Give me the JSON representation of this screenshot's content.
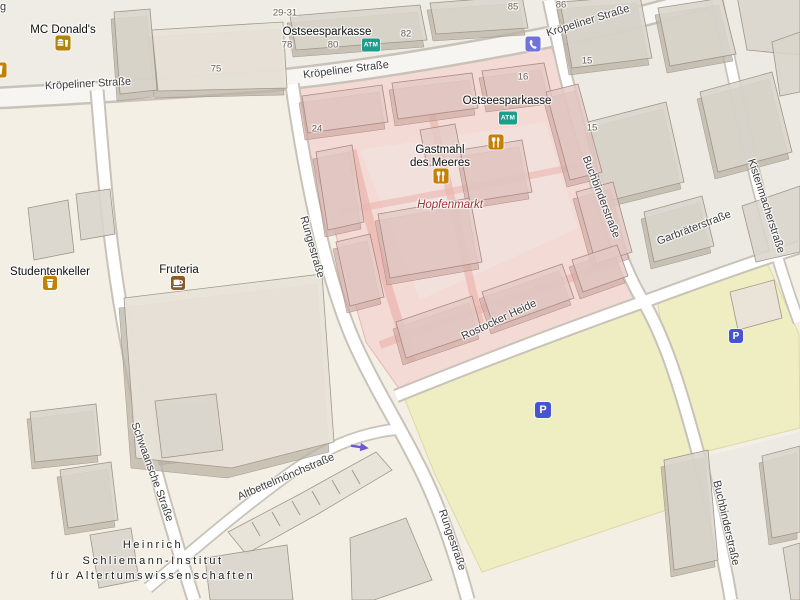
{
  "map": {
    "streets": [
      {
        "label": "Kröpeliner Straße"
      },
      {
        "label": "Kröpeliner Straße"
      },
      {
        "label": "Kröpeliner Straße"
      },
      {
        "label": "Rungestraße"
      },
      {
        "label": "Rungestraße"
      },
      {
        "label": "Buchbinderstraße"
      },
      {
        "label": "Buchbinderstraße"
      },
      {
        "label": "Kistenmacherstraße"
      },
      {
        "label": "Garbräterstraße"
      },
      {
        "label": "Rostocker Heide"
      },
      {
        "label": "Schwaansche Straße"
      },
      {
        "label": "Altbettelmönchstraße"
      }
    ],
    "pois": {
      "mcdonalds": "MC Donald's",
      "ostseesparkasse_1": "Ostseesparkasse",
      "ostseesparkasse_2": "Ostseesparkasse",
      "gastmahl_line1": "Gastmahl",
      "gastmahl_line2": "des Meeres",
      "hopfenmarkt": "Hopfenmarkt",
      "studentenkeller": "Studentenkeller",
      "fruteria": "Fruteria",
      "institute_line1": "Heinrich",
      "institute_line2": "Schliemann-Institut",
      "institute_line3": "für Altertumswissenschaften"
    },
    "house_numbers": [
      {
        "label": "29-31"
      },
      {
        "label": "75"
      },
      {
        "label": "78"
      },
      {
        "label": "80"
      },
      {
        "label": "82"
      },
      {
        "label": "85"
      },
      {
        "label": "86"
      },
      {
        "label": "16"
      },
      {
        "label": "15"
      },
      {
        "label": "15"
      },
      {
        "label": "24"
      }
    ],
    "icon_labels": {
      "atm": "ATM",
      "parking": "P"
    },
    "icons": {
      "atm": "teal ATM badge",
      "parking": "blue parking square",
      "phone": "purple phone handset",
      "restaurant": "orange fork and knife",
      "fastfood": "gold burger and drink",
      "bar": "orange drink glass",
      "cafe": "brown coffee cup",
      "oneway": "purple left arrow"
    },
    "edge_fragment": "g",
    "colors": {
      "land": "#f3efe5",
      "pedestrian_block": "#efece6",
      "market_overlay": "#f3dad4",
      "market_path": "#ecb6b0",
      "parking_lot": "#efedc2",
      "road": "#ffffff",
      "building_roof": "#dad5cc",
      "building_wall": "#b9b1a4",
      "pink_roof": "#e3c9c4",
      "atm_teal": "#1d9d8b",
      "poi_orange": "#c58000",
      "fastfood_gold": "#b08408",
      "cafe_brown": "#8a5a28",
      "phone_purple": "#7173d9",
      "parking_blue": "#4653d2",
      "oneway_purple": "#6a5ad2",
      "market_text": "#9c3434"
    }
  }
}
